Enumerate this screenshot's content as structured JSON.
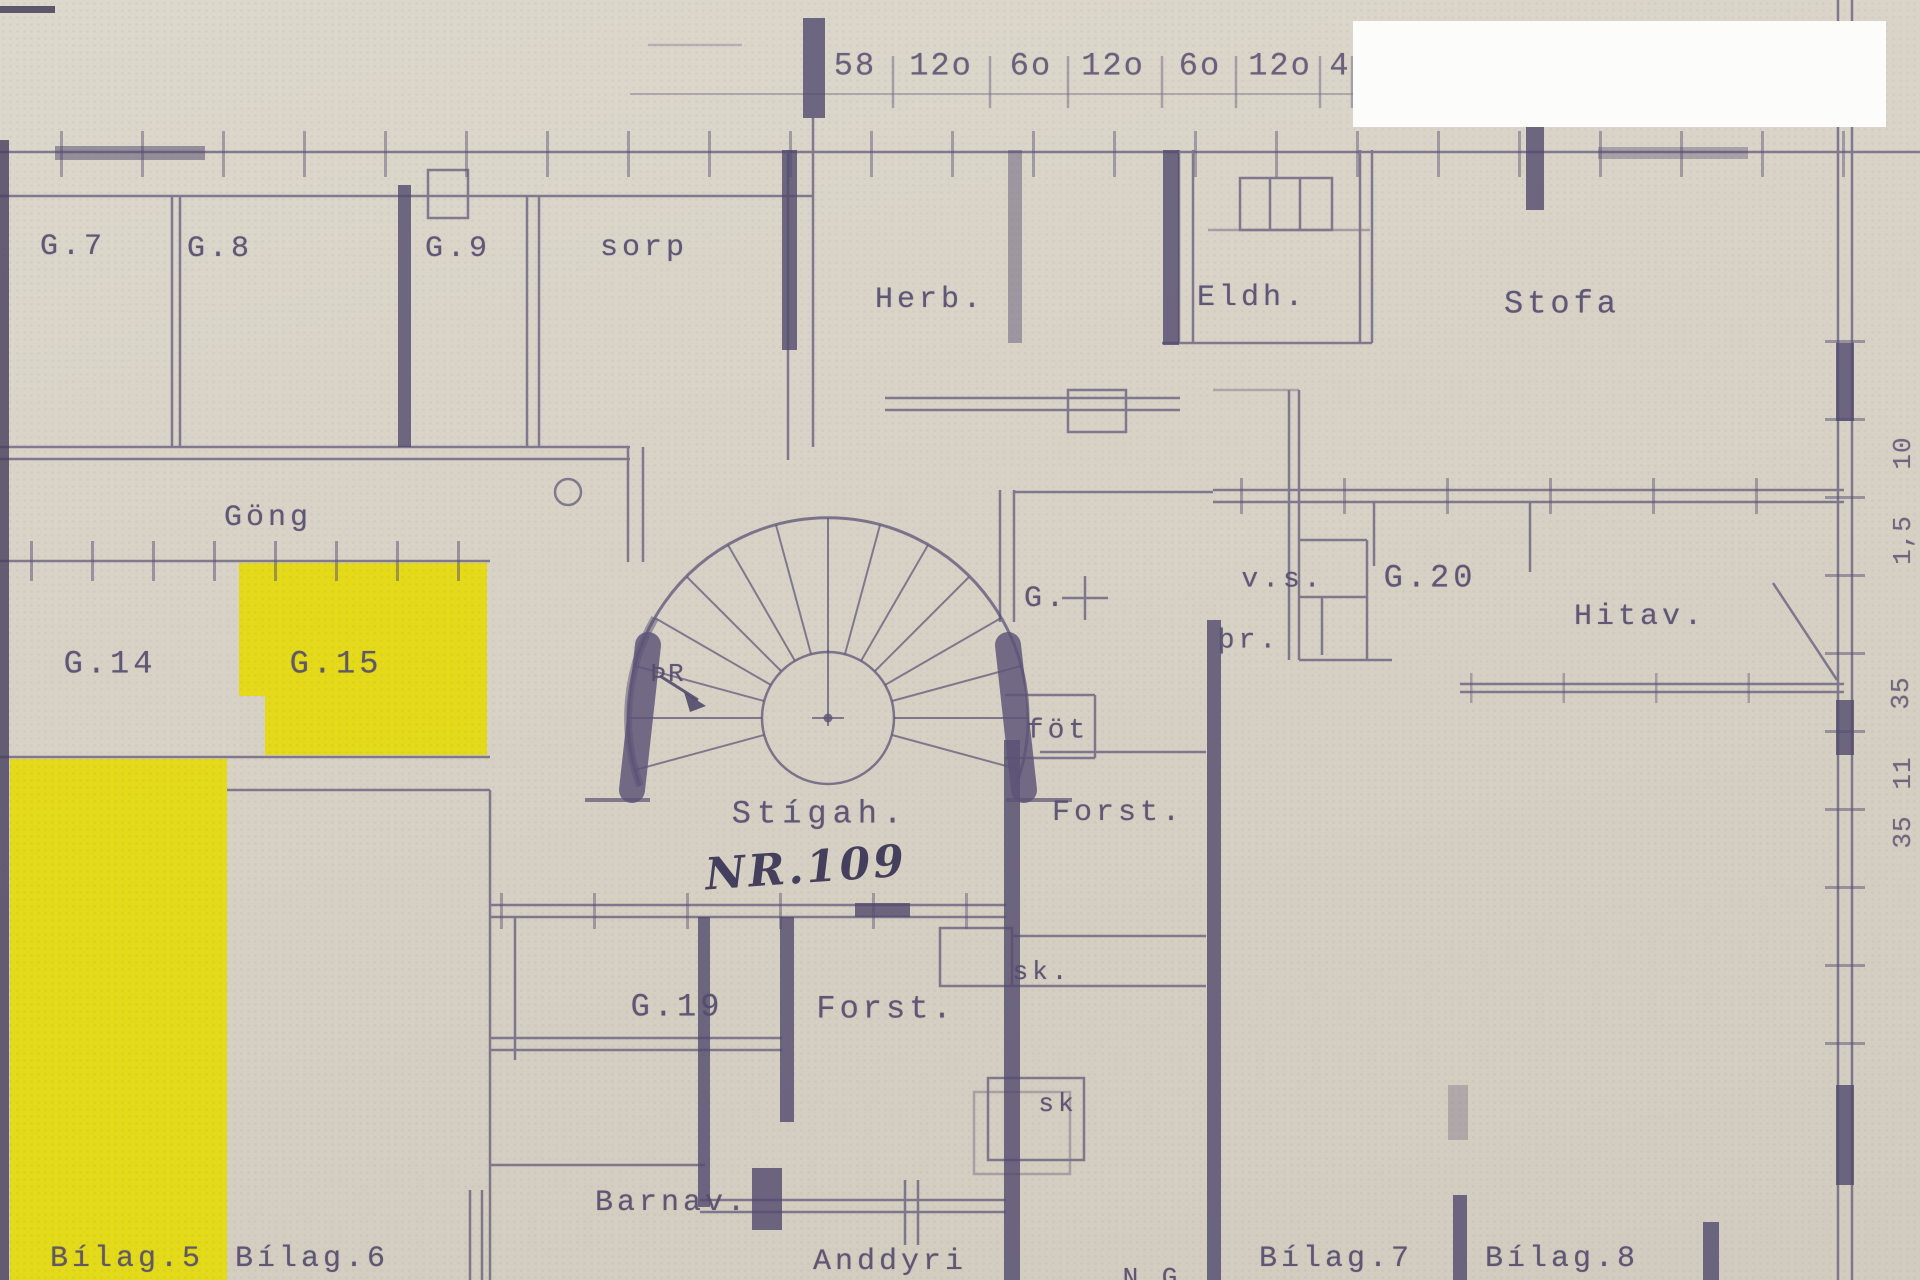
{
  "logo": {
    "text": "EIGNAMIÐLUN",
    "icon": "house-icon"
  },
  "top_dimensions": [
    "58",
    "12o",
    "6o",
    "12o",
    "6o",
    "12o",
    "4"
  ],
  "right_dimensions": [
    "10",
    "1,5",
    "35",
    "11",
    "35"
  ],
  "room_labels": {
    "g7": "G.7",
    "g8": "G.8",
    "g9": "G.9",
    "sorp": "sorp",
    "herb": "Herb.",
    "eldh": "Eldh.",
    "stofa": "Stofa",
    "gong": "Göng",
    "g14": "G.14",
    "g15": "G.15",
    "door": "ÞR",
    "stigah": "Stígah.",
    "g": "G.",
    "vs": "v.s.",
    "thr": "þr.",
    "g20": "G.20",
    "hitav": "Hitav.",
    "fot": "föt",
    "forst_upper": "Forst.",
    "sk_upper": "sk.",
    "g19": "G.19",
    "forst_lower": "Forst.",
    "sk_lower": "sk",
    "barnav": "Barnav.",
    "anddyri": "Anddyri",
    "ng_partial": "N.G",
    "bilag5": "Bílag.5",
    "bilag6": "Bílag.6",
    "bilag7": "Bílag.7",
    "bilag8": "Bílag.8"
  },
  "annotations": {
    "unit_number": "NR.109"
  },
  "colors": {
    "paper": "#d9d3c7",
    "ink": "#554c6e",
    "highlight": "#e4da0c",
    "logo_text_blue": "#1d4f94",
    "logo_roof_blue": "#2a5c94",
    "logo_orange": "#f3a02b"
  }
}
